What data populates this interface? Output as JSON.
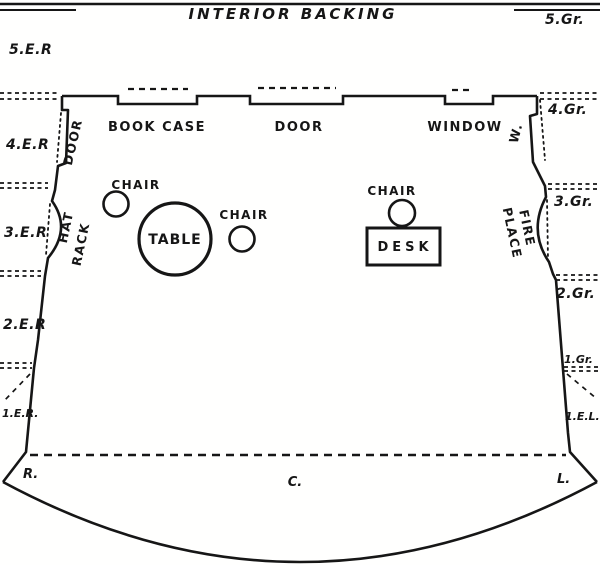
{
  "title": "INTERIOR BACKING",
  "colors": {
    "ink": "#161616",
    "paper": "#fffffe"
  },
  "stage_positions": {
    "top_left": "5.E.R",
    "top_right": "5.Gr.",
    "wings_left": [
      "4.E.R",
      "3.E.R",
      "2.E.R",
      "1.E.R."
    ],
    "wings_right": [
      "4.Gr.",
      "3.Gr.",
      "2.Gr.",
      "1.Gr.",
      "1.E.L."
    ],
    "footline": {
      "right": "R.",
      "center": "C.",
      "left": "L."
    }
  },
  "back_wall": {
    "bookcase": "BOOK CASE",
    "door": "DOOR",
    "window": "WINDOW"
  },
  "left_wall": {
    "door": "DOOR",
    "hat_rack_line1": "HAT",
    "hat_rack_line2": "RACK"
  },
  "right_wall": {
    "window": "W.",
    "fireplace_line1": "FIRE",
    "fireplace_line2": "PLACE"
  },
  "furniture": {
    "chair_left": "CHAIR",
    "chair_center": "CHAIR",
    "chair_right": "CHAIR",
    "table": "TABLE",
    "desk": "DESK"
  }
}
